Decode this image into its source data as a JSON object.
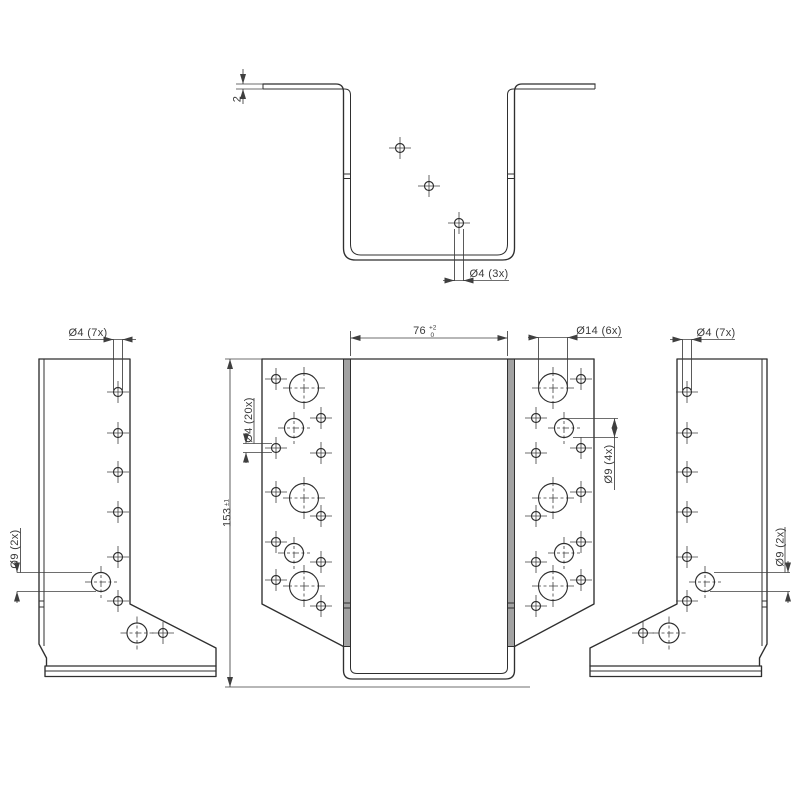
{
  "drawing": {
    "type": "technical-drawing",
    "subject": "sheet-metal joist hanger, orthographic views",
    "colors": {
      "line": "#2f2f2f",
      "dim_line": "#3f3f3f",
      "section_gray": "#a2a2a2",
      "background": "#ffffff"
    }
  },
  "labels": {
    "thickness": "2",
    "top_holes": "Ø4 (3x)",
    "side_holes_left": "Ø4 (7x)",
    "side_holes_right": "Ø4 (7x)",
    "width_value": "76",
    "width_tol_upper": "+2",
    "width_tol_lower": "0",
    "flange_large_holes": "Ø14 (6x)",
    "flange_small_holes": "Ø4 (20x)",
    "flange_mid_holes": "Ø9 (4x)",
    "height_value": "153",
    "height_tol": "±1",
    "side_large_holes_left": "Ø9 (2x)",
    "side_large_holes_right": "Ø9 (2x)"
  },
  "holes": {
    "top_view": [
      [
        400,
        148,
        4.5
      ],
      [
        429,
        186,
        4.5
      ],
      [
        459,
        223,
        4.5
      ]
    ],
    "left_side": [
      [
        118,
        392,
        4.5
      ],
      [
        118,
        433,
        4.5
      ],
      [
        118,
        472,
        4.5
      ],
      [
        118,
        512,
        4.5
      ],
      [
        118,
        557,
        4.5
      ],
      [
        118,
        601,
        4.5
      ],
      [
        163,
        633,
        4.5
      ],
      [
        101,
        582,
        9.5
      ],
      [
        137,
        633,
        10
      ]
    ],
    "right_side": [
      [
        687,
        392,
        4.5
      ],
      [
        687,
        433,
        4.5
      ],
      [
        687,
        472,
        4.5
      ],
      [
        687,
        512,
        4.5
      ],
      [
        687,
        557,
        4.5
      ],
      [
        687,
        601,
        4.5
      ],
      [
        643,
        633,
        4.5
      ],
      [
        705,
        582,
        9.5
      ],
      [
        669,
        633,
        10
      ]
    ],
    "front_left_flange": [
      [
        276,
        379,
        4.5
      ],
      [
        276,
        448,
        4.5
      ],
      [
        276,
        492,
        4.5
      ],
      [
        276,
        542,
        4.5
      ],
      [
        276,
        580,
        4.5
      ],
      [
        321,
        418,
        4.5
      ],
      [
        321,
        453,
        4.5
      ],
      [
        321,
        516,
        4.5
      ],
      [
        321,
        562,
        4.5
      ],
      [
        321,
        606,
        4.5
      ],
      [
        294,
        428,
        9.5
      ],
      [
        294,
        553,
        9.5
      ],
      [
        304,
        388,
        14.5
      ],
      [
        304,
        498,
        14.5
      ],
      [
        304,
        586,
        14.5
      ]
    ],
    "front_right_flange": [
      [
        581,
        379,
        4.5
      ],
      [
        581,
        448,
        4.5
      ],
      [
        581,
        492,
        4.5
      ],
      [
        581,
        542,
        4.5
      ],
      [
        581,
        580,
        4.5
      ],
      [
        536,
        418,
        4.5
      ],
      [
        536,
        453,
        4.5
      ],
      [
        536,
        516,
        4.5
      ],
      [
        536,
        562,
        4.5
      ],
      [
        536,
        606,
        4.5
      ],
      [
        564,
        428,
        9.5
      ],
      [
        564,
        553,
        9.5
      ],
      [
        553,
        388,
        14.5
      ],
      [
        553,
        498,
        14.5
      ],
      [
        553,
        586,
        14.5
      ]
    ]
  }
}
